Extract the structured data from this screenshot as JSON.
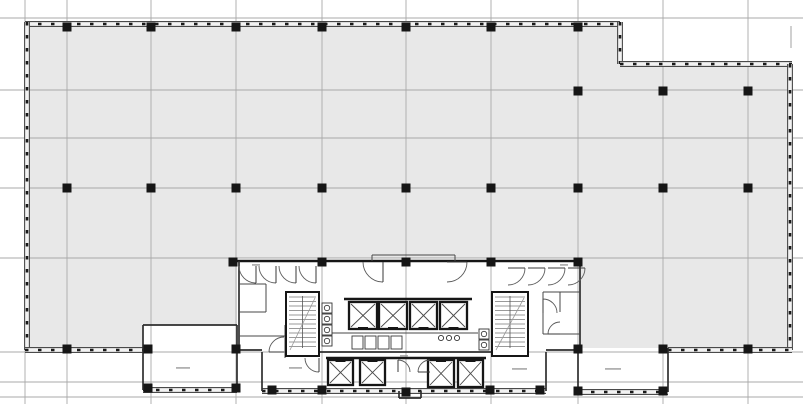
{
  "meta": {
    "canvas_w": 803,
    "canvas_h": 404
  },
  "colors": {
    "background": "#ffffff",
    "floor_plate": "#e8e8e8",
    "gridline": "#a9a9a9",
    "wall_edge": "#4a4a4a",
    "wall_band": "#f2f2f2",
    "mullion": "#1a1a1a",
    "core_wall": "#161616",
    "medium_wall": "#2e2e2e",
    "thin_wall": "#474747",
    "column": "#161616",
    "tread": "#787878",
    "annotation": "#979797"
  },
  "grid": {
    "vertical_x": [
      25,
      67,
      151,
      236,
      322,
      406,
      491,
      578,
      663,
      748
    ],
    "horizontal_y": [
      18,
      90,
      138,
      188,
      258,
      352,
      382,
      397
    ],
    "stub_lines": [
      [
        791,
        26,
        791,
        48
      ]
    ]
  },
  "floor_plate": {
    "outline": [
      [
        25,
        21
      ],
      [
        620,
        21
      ],
      [
        620,
        64
      ],
      [
        792,
        64
      ],
      [
        792,
        352
      ],
      [
        25,
        352
      ]
    ],
    "white_cutouts": [
      [
        237,
        258,
        343,
        95
      ],
      [
        143,
        325,
        94,
        65
      ],
      [
        578,
        348,
        90,
        44
      ],
      [
        262,
        352,
        284,
        40
      ]
    ]
  },
  "walls": {
    "mullioned": [
      [
        25,
        24,
        620,
        24
      ],
      [
        620,
        22,
        620,
        64
      ],
      [
        620,
        64,
        792,
        64
      ],
      [
        790,
        64,
        790,
        350
      ],
      [
        27,
        22,
        27,
        350
      ],
      [
        25,
        350,
        143,
        350
      ],
      [
        668,
        350,
        792,
        350
      ],
      [
        143,
        390,
        237,
        390
      ],
      [
        578,
        392,
        668,
        392
      ],
      [
        262,
        391,
        546,
        391
      ]
    ],
    "thick": [
      [
        237,
        261,
        580,
        261
      ],
      [
        344,
        299,
        472,
        299
      ],
      [
        326,
        358,
        486,
        358
      ]
    ],
    "medium": [
      [
        143,
        325,
        143,
        390
      ],
      [
        143,
        325,
        237,
        325
      ],
      [
        237,
        325,
        237,
        390
      ],
      [
        578,
        348,
        578,
        392
      ],
      [
        668,
        348,
        668,
        392
      ],
      [
        239,
        261,
        239,
        352
      ],
      [
        580,
        261,
        580,
        350
      ],
      [
        262,
        352,
        262,
        391
      ],
      [
        546,
        352,
        546,
        391
      ],
      [
        319,
        352,
        492,
        352
      ],
      [
        237,
        350,
        262,
        350
      ],
      [
        546,
        350,
        578,
        350
      ],
      [
        399,
        391,
        399,
        398
      ],
      [
        421,
        391,
        421,
        398
      ],
      [
        399,
        398,
        421,
        398
      ]
    ],
    "thin": [
      [
        239,
        284,
        266,
        284
      ],
      [
        266,
        284,
        266,
        312
      ],
      [
        239,
        312,
        266,
        312
      ],
      [
        239,
        336,
        285,
        336
      ],
      [
        285,
        325,
        285,
        358
      ],
      [
        543,
        292,
        580,
        292
      ],
      [
        543,
        292,
        543,
        334
      ],
      [
        543,
        334,
        580,
        334
      ],
      [
        560,
        292,
        560,
        312
      ],
      [
        322,
        333,
        478,
        333
      ],
      [
        372,
        255,
        372,
        261
      ],
      [
        455,
        255,
        455,
        261
      ],
      [
        372,
        255,
        455,
        255
      ]
    ]
  },
  "columns": {
    "size": 9,
    "positions": [
      [
        67,
        27
      ],
      [
        151,
        27
      ],
      [
        236,
        27
      ],
      [
        322,
        27
      ],
      [
        406,
        27
      ],
      [
        491,
        27
      ],
      [
        578,
        27
      ],
      [
        578,
        91
      ],
      [
        663,
        91
      ],
      [
        748,
        91
      ],
      [
        67,
        188
      ],
      [
        151,
        188
      ],
      [
        236,
        188
      ],
      [
        322,
        188
      ],
      [
        406,
        188
      ],
      [
        491,
        188
      ],
      [
        578,
        188
      ],
      [
        663,
        188
      ],
      [
        748,
        188
      ],
      [
        67,
        349
      ],
      [
        148,
        349
      ],
      [
        236,
        349
      ],
      [
        578,
        349
      ],
      [
        663,
        349
      ],
      [
        748,
        349
      ],
      [
        233,
        262
      ],
      [
        322,
        262
      ],
      [
        406,
        262
      ],
      [
        491,
        262
      ],
      [
        578,
        262
      ],
      [
        272,
        390
      ],
      [
        322,
        390
      ],
      [
        406,
        392
      ],
      [
        490,
        390
      ],
      [
        540,
        390
      ],
      [
        148,
        388
      ],
      [
        236,
        388
      ],
      [
        578,
        391
      ],
      [
        663,
        391
      ]
    ]
  },
  "stairs": [
    {
      "x": 286,
      "y": 292,
      "w": 33,
      "h": 64
    },
    {
      "x": 492,
      "y": 292,
      "w": 36,
      "h": 64
    }
  ],
  "elevators": {
    "upper_bank": {
      "sill": "bottom",
      "shafts": [
        [
          349,
          302,
          28,
          27
        ],
        [
          379,
          302,
          28,
          27
        ],
        [
          410,
          302,
          27,
          27
        ],
        [
          440,
          302,
          27,
          27
        ]
      ]
    },
    "lower_bank": {
      "sill": "top",
      "shafts": [
        [
          328,
          360,
          25,
          25
        ],
        [
          360,
          360,
          25,
          25
        ],
        [
          428,
          360,
          26,
          27
        ],
        [
          458,
          360,
          25,
          27
        ]
      ]
    }
  },
  "fixtures": {
    "stacks": [
      {
        "x": 322,
        "y": 303,
        "n": 4,
        "step": 11,
        "size": 10
      },
      {
        "x": 479,
        "y": 329,
        "n": 2,
        "step": 11,
        "size": 10
      }
    ],
    "stalls": [
      [
        352,
        336,
        11,
        13
      ],
      [
        365,
        336,
        11,
        13
      ],
      [
        378,
        336,
        11,
        13
      ],
      [
        391,
        336,
        11,
        13
      ]
    ],
    "sinks": [
      [
        441,
        338
      ],
      [
        449,
        338
      ],
      [
        457,
        338
      ]
    ]
  },
  "door_swings": [
    [
      256,
      266,
      17,
      90,
      180
    ],
    [
      276,
      266,
      17,
      90,
      180
    ],
    [
      296,
      266,
      17,
      90,
      180
    ],
    [
      316,
      266,
      17,
      90,
      180
    ],
    [
      508,
      268,
      17,
      0,
      90
    ],
    [
      528,
      268,
      17,
      0,
      90
    ],
    [
      548,
      268,
      17,
      0,
      90
    ],
    [
      568,
      268,
      17,
      0,
      90
    ],
    [
      383,
      262,
      20,
      90,
      180
    ],
    [
      447,
      262,
      20,
      0,
      90
    ],
    [
      284,
      352,
      15,
      180,
      270
    ],
    [
      543,
      313,
      14,
      270,
      360
    ],
    [
      560,
      334,
      12,
      180,
      270
    ],
    [
      319,
      358,
      14,
      90,
      180
    ],
    [
      398,
      372,
      12,
      270,
      360
    ],
    [
      430,
      372,
      12,
      180,
      270
    ]
  ],
  "annotations_illegible": [
    {
      "x": 176,
      "y": 367,
      "w": 14
    },
    {
      "x": 605,
      "y": 368,
      "w": 16
    },
    {
      "x": 289,
      "y": 367,
      "w": 13
    },
    {
      "x": 512,
      "y": 368,
      "w": 15
    },
    {
      "x": 400,
      "y": 355,
      "w": 8
    },
    {
      "x": 560,
      "y": 264,
      "w": 8
    },
    {
      "x": 252,
      "y": 264,
      "w": 8
    }
  ]
}
